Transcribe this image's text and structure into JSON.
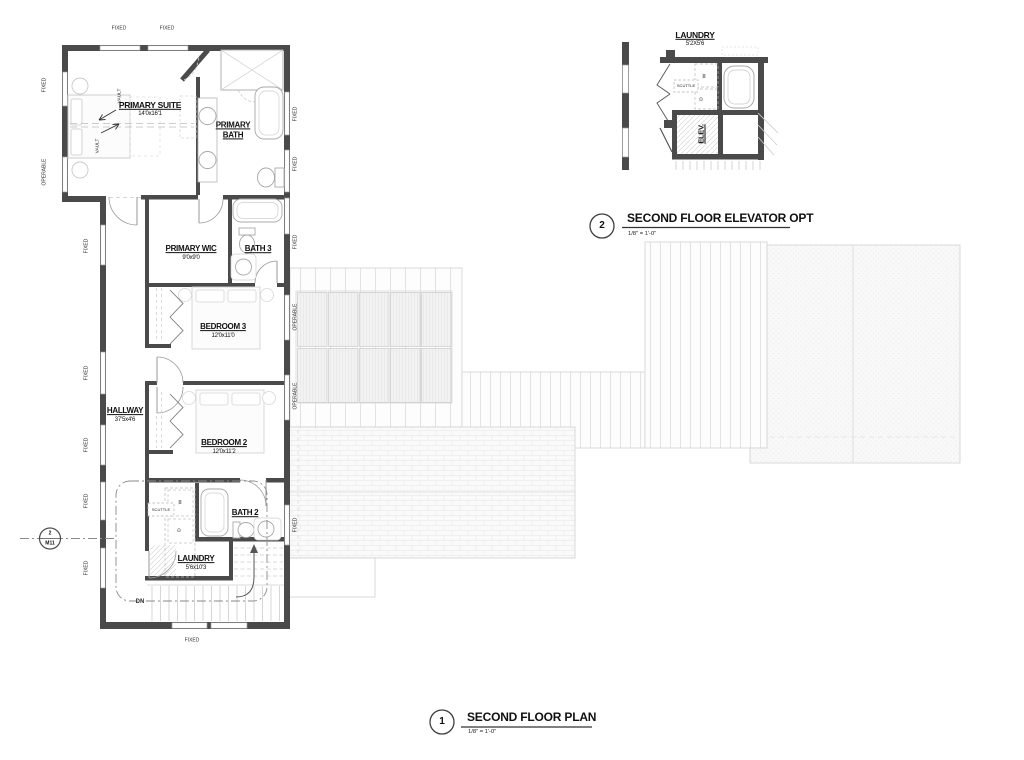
{
  "colors": {
    "wall": "#4a4a4a",
    "ink": "#111111",
    "fixture": "#a8a8a8",
    "roof_line": "#e0e0e0"
  },
  "main_plan": {
    "rooms": {
      "primary_suite": {
        "name": "PRIMARY SUITE",
        "dims": "14'0x16'1"
      },
      "primary_bath": {
        "line1": "PRIMARY",
        "line2": "BATH"
      },
      "primary_wic": {
        "name": "PRIMARY WIC",
        "dims": "9'0x9'0"
      },
      "bath3": {
        "name": "BATH 3"
      },
      "bedroom3": {
        "name": "BEDROOM 3",
        "dims": "12'0x11'0"
      },
      "hallway": {
        "name": "HALLWAY",
        "dims": "37'5x4'6"
      },
      "bedroom2": {
        "name": "BEDROOM 2",
        "dims": "12'0x11'2"
      },
      "bath2": {
        "name": "BATH 2"
      },
      "laundry": {
        "name": "LAUNDRY",
        "dims": "5'6x10'3"
      }
    },
    "windows": {
      "top": [
        "FIXED",
        "FIXED"
      ],
      "left": [
        "FIXED",
        "OPERABLE",
        "FIXED",
        "FIXED",
        "FIXED",
        "FIXED",
        "FIXED"
      ],
      "right": [
        "FIXED",
        "FIXED",
        "FIXED",
        "OPERABLE",
        "OPERABLE",
        "FIXED"
      ],
      "bottom": [
        "FIXED"
      ]
    },
    "annotations": {
      "vault": "VAULT",
      "scuttle": "SCUTTLE",
      "washer": "W",
      "dryer": "D",
      "down": "DN"
    },
    "section_marker": {
      "number": "2",
      "sheet": "M11"
    }
  },
  "elevator_plan": {
    "rooms": {
      "laundry": {
        "name": "LAUNDRY",
        "dims": "5'2X5'6"
      },
      "elevator": {
        "name": "ELEV."
      }
    },
    "annotations": {
      "scuttle": "SCUTTLE",
      "washer": "W",
      "dryer": "D"
    }
  },
  "callouts": {
    "elevator": {
      "number": "2",
      "title": "SECOND FLOOR ELEVATOR OPT",
      "scale": "1/8\" = 1'-0\""
    },
    "main": {
      "number": "1",
      "title": "SECOND FLOOR PLAN",
      "scale": "1/8\" = 1'-0\""
    }
  }
}
